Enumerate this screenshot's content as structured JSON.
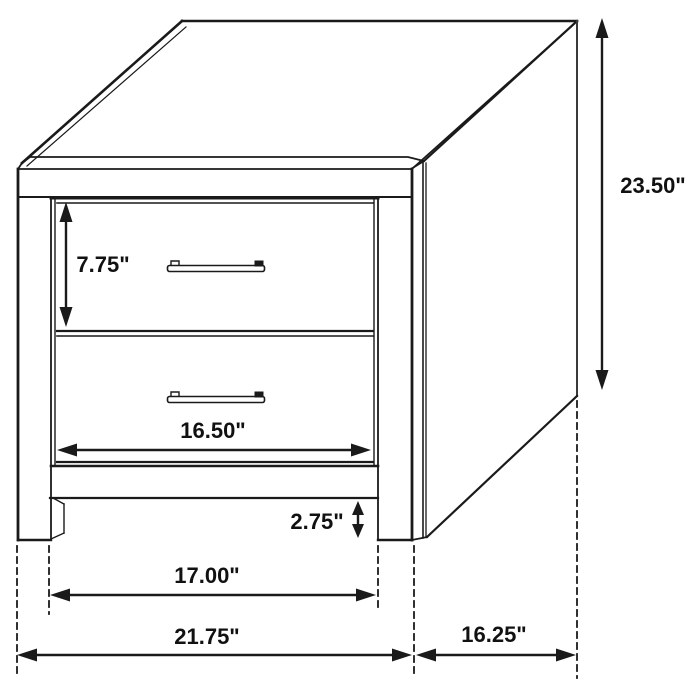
{
  "diagram": {
    "labels": {
      "height": "23.50\"",
      "drawer_height": "7.75\"",
      "drawer_width": "16.50\"",
      "base_clearance": "2.75\"",
      "leg_span_width": "17.00\"",
      "overall_width": "21.75\"",
      "depth": "16.25\""
    },
    "colors": {
      "line": "#1a1a1a",
      "background": "#ffffff"
    }
  }
}
